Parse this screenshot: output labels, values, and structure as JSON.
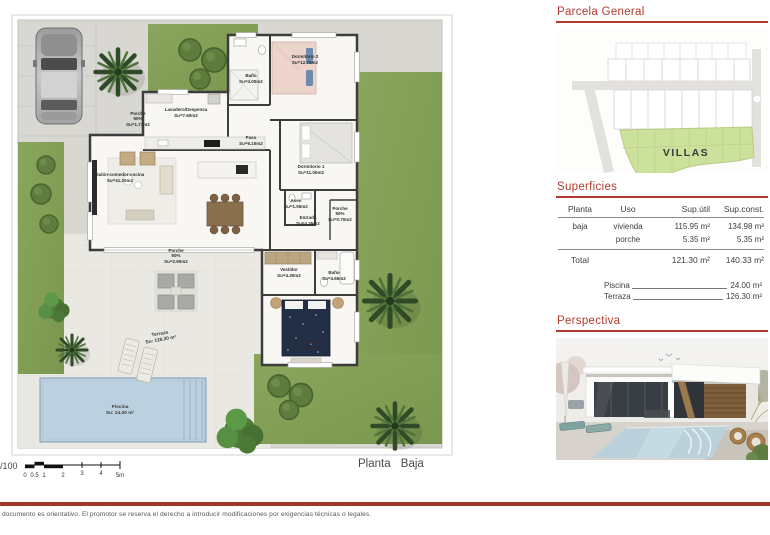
{
  "doc": {
    "scale_ratio": "1/100",
    "plan_name": "Planta Baja",
    "disclaimer": "documento es orientativo. El promotor se reserva el derecho a introducir modificaciones por exigencias técnicas o legales.",
    "scale_ticks": [
      "0",
      "0.5",
      "1",
      "2",
      "3",
      "4",
      "5m"
    ]
  },
  "plan": {
    "rooms": {
      "dormitorio2": {
        "name": "Dormitorio 2",
        "area": "Su=12.75m2"
      },
      "bano_top": {
        "name": "Baño",
        "area": "Su=4.00m2"
      },
      "lavadero": {
        "name": "Lavadero/Despensa",
        "area": "Su=7.60m2"
      },
      "porche_entrada": {
        "name": "Porche",
        "pct": "50%",
        "area": "Su=1.73m2"
      },
      "paso": {
        "name": "Paso",
        "area": "Su=6.15m2"
      },
      "dormitorio1": {
        "name": "Dormitorio 1",
        "area": "Su=11.00m2"
      },
      "salon": {
        "name": "Salón-comedor-cocina",
        "area": "Su=41.20m2"
      },
      "aseo": {
        "name": "Aseo",
        "area": "Su=1.55m2"
      },
      "entrada": {
        "name": "Entrada",
        "area": "Su=4.35m2"
      },
      "porche_lateral": {
        "name": "Porche",
        "pct": "50%",
        "area": "Su=0.70m2"
      },
      "porche_salon": {
        "name": "Porche",
        "pct": "50%",
        "area": "Su=2.90m2"
      },
      "vestidor": {
        "name": "Vestidor",
        "area": "Su=4.30m2"
      },
      "bano_suite": {
        "name": "Baño",
        "area": "Su=4.65m2"
      },
      "dormitorio3": {
        "name": "Dormitorio 3",
        "area": "Su=15.60m2"
      },
      "terraza": {
        "name": "Terraza",
        "area": "Su: 126.30 m²"
      },
      "piscina": {
        "name": "Piscina",
        "area": "Su: 24.00 m²"
      }
    }
  },
  "sidebar": {
    "parcela": {
      "title": "Parcela General",
      "map_label": "VILLAS"
    },
    "superficies": {
      "title": "Superficies",
      "headers": {
        "planta": "Planta",
        "uso": "Uso",
        "util": "Sup.útil",
        "constr": "Sup.const."
      },
      "rows": [
        {
          "planta": "baja",
          "uso": "vivienda",
          "util": "115.95 m²",
          "constr": "134.98 m²"
        },
        {
          "planta": "",
          "uso": "porche",
          "util": "5.35 m²",
          "constr": "5.35 m²"
        }
      ],
      "total": {
        "label": "Total",
        "util": "121.30 m²",
        "constr": "140.33 m²"
      },
      "extras": [
        {
          "label": "Piscina",
          "value": "24.00 m²"
        },
        {
          "label": "Terraza",
          "value": "126.30 m²"
        }
      ]
    },
    "perspectiva": {
      "title": "Perspectiva"
    }
  }
}
